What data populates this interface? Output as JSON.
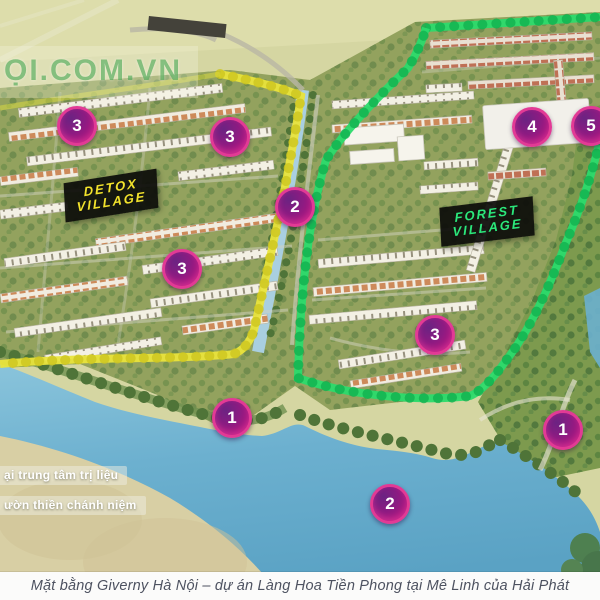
{
  "watermark": {
    "text": "ỌI.COM.VN"
  },
  "caption": {
    "text": "Mặt bằng Giverny Hà Nội – dự án Làng Hoa Tiền Phong tại Mê Linh của Hải Phát"
  },
  "signs": {
    "detox": {
      "line1": "DETOX",
      "line2": "VILLAGE",
      "text_color": "#f2e22c"
    },
    "forest": {
      "line1": "FOREST",
      "line2": "VILLAGE",
      "text_color": "#2be87b"
    }
  },
  "area_labels": [
    {
      "text": "ại trung tâm trị liệu"
    },
    {
      "text": "ườn thiền chánh niệm"
    }
  ],
  "markers": [
    {
      "label": "3",
      "x": 77,
      "y": 126
    },
    {
      "label": "3",
      "x": 230,
      "y": 137
    },
    {
      "label": "2",
      "x": 295,
      "y": 207
    },
    {
      "label": "3",
      "x": 182,
      "y": 269
    },
    {
      "label": "4",
      "x": 532,
      "y": 127
    },
    {
      "label": "5",
      "x": 591,
      "y": 126
    },
    {
      "label": "3",
      "x": 435,
      "y": 335
    },
    {
      "label": "1",
      "x": 232,
      "y": 418
    },
    {
      "label": "2",
      "x": 390,
      "y": 504
    },
    {
      "label": "1",
      "x": 563,
      "y": 430
    }
  ],
  "map_colors": {
    "boundary_yellow": "#e9e43c",
    "boundary_green": "#2bdb6b",
    "marker_magenta": "#c9157f",
    "canal_blue": "#a9cfe0",
    "lake_blue": "#5fa6c6"
  }
}
